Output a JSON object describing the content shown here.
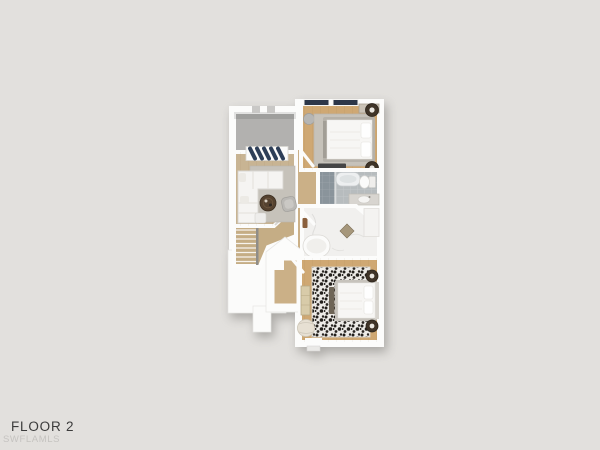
{
  "page": {
    "background_style": "background:#e2e0dd"
  },
  "caption": {
    "title": "FLOOR 2",
    "watermark": "SWFLAMLS"
  },
  "palette": {
    "wall": "#fcfcfb",
    "balcony_floor": "#b2b1af",
    "wood_living": "#c8b493",
    "wood_hall": "#cbb087",
    "wood_bedroom": "#cfa873",
    "tile_bath": "#b7bcbe",
    "tile_shower": "#8a949b",
    "marble": "#f1f0ee",
    "rug_gray": "#c6c2ba",
    "accent_navy": "#2d3e57",
    "furniture_dark": "#3f3428",
    "bed_white": "#f7f6f4"
  },
  "floorplan": {
    "rooms": [
      {
        "name": "balcony"
      },
      {
        "name": "living-room"
      },
      {
        "name": "bedroom-top"
      },
      {
        "name": "bathroom"
      },
      {
        "name": "bathroom-marble"
      },
      {
        "name": "bedroom-bottom"
      },
      {
        "name": "hallway"
      },
      {
        "name": "stairs"
      },
      {
        "name": "closet"
      }
    ]
  }
}
